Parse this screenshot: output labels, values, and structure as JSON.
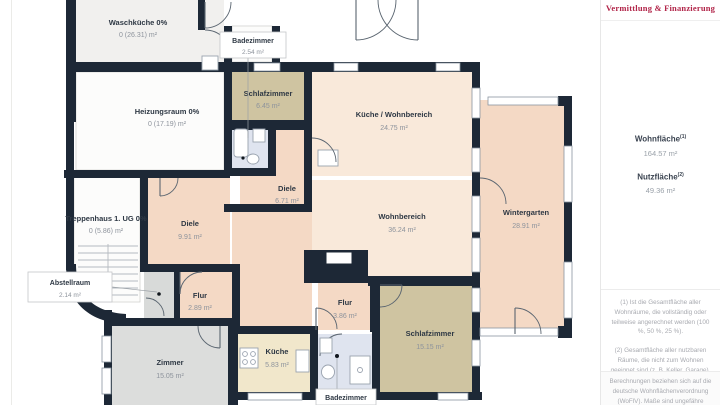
{
  "plan": {
    "colors": {
      "wall": "#1d2836",
      "room_peach_light": "#f9e9da",
      "room_peach": "#f4d9c5",
      "room_tan": "#cfc4a1",
      "room_cream": "#f1e7cb",
      "room_gray_light": "#f1f0ee",
      "room_gray": "#dcdddc",
      "room_blue": "#dfe4ef",
      "room_white": "#fcfcfb",
      "text_dark": "#2e3844",
      "text_gray": "#8d939c"
    },
    "rooms": [
      {
        "id": "waschkueche",
        "name": "Waschküche 0%",
        "area": "0 (26.31) m²"
      },
      {
        "id": "heizungsraum",
        "name": "Heizungsraum 0%",
        "area": "0 (17.19) m²"
      },
      {
        "id": "badezimmer-og",
        "name": "Badezimmer",
        "area": "2.54 m²"
      },
      {
        "id": "schlafzimmer-klein",
        "name": "Schlafzimmer",
        "area": "6.45 m²"
      },
      {
        "id": "kueche-wohnbereich",
        "name": "Küche / Wohnbereich",
        "area": "24.75 m²"
      },
      {
        "id": "diele-klein",
        "name": "Diele",
        "area": "6.71 m²"
      },
      {
        "id": "treppenhaus",
        "name": "Treppenhaus 1. UG 0%",
        "area": "0 (5.86) m²"
      },
      {
        "id": "diele",
        "name": "Diele",
        "area": "9.91 m²"
      },
      {
        "id": "wohnbereich",
        "name": "Wohnbereich",
        "area": "36.24 m²"
      },
      {
        "id": "wintergarten",
        "name": "Wintergarten",
        "area": "28.91 m²"
      },
      {
        "id": "abstellraum",
        "name": "Abstellraum",
        "area": "2.14 m²"
      },
      {
        "id": "flur-klein",
        "name": "Flur",
        "area": "2.89 m²"
      },
      {
        "id": "flur",
        "name": "Flur",
        "area": "3.86 m²"
      },
      {
        "id": "schlafzimmer",
        "name": "Schlafzimmer",
        "area": "15.15 m²"
      },
      {
        "id": "kueche",
        "name": "Küche",
        "area": "5.83 m²"
      },
      {
        "id": "zimmer",
        "name": "Zimmer",
        "area": "15.05 m²"
      },
      {
        "id": "badezimmer-eg",
        "name": "Badezimmer",
        "area": ""
      }
    ]
  },
  "sidebar": {
    "brand_tagline": "Vermittlung & Finanzierung",
    "brand_color": "#b2264a",
    "wohnflaeche": {
      "label": "Wohnfläche",
      "sup": "(1)",
      "value": "164.57 m²"
    },
    "nutzflaeche": {
      "label": "Nutzfläche",
      "sup": "(2)",
      "value": "49.36 m²"
    },
    "footnote_1": "(1) Ist die Gesamtfläche aller Wohnräume, die vollständig oder teilweise angerechnet werden (100 %, 50 %, 25 %).",
    "footnote_2": "(2) Gesamtfläche aller nutzbaren Räume, die nicht zum Wohnen geeignet sind (z. B. Keller, Garage).",
    "disclaimer": "Berechnungen beziehen sich auf die deutsche Wohnflächenverordnung (WoFlV). Maße sind ungefähre Angaben"
  }
}
